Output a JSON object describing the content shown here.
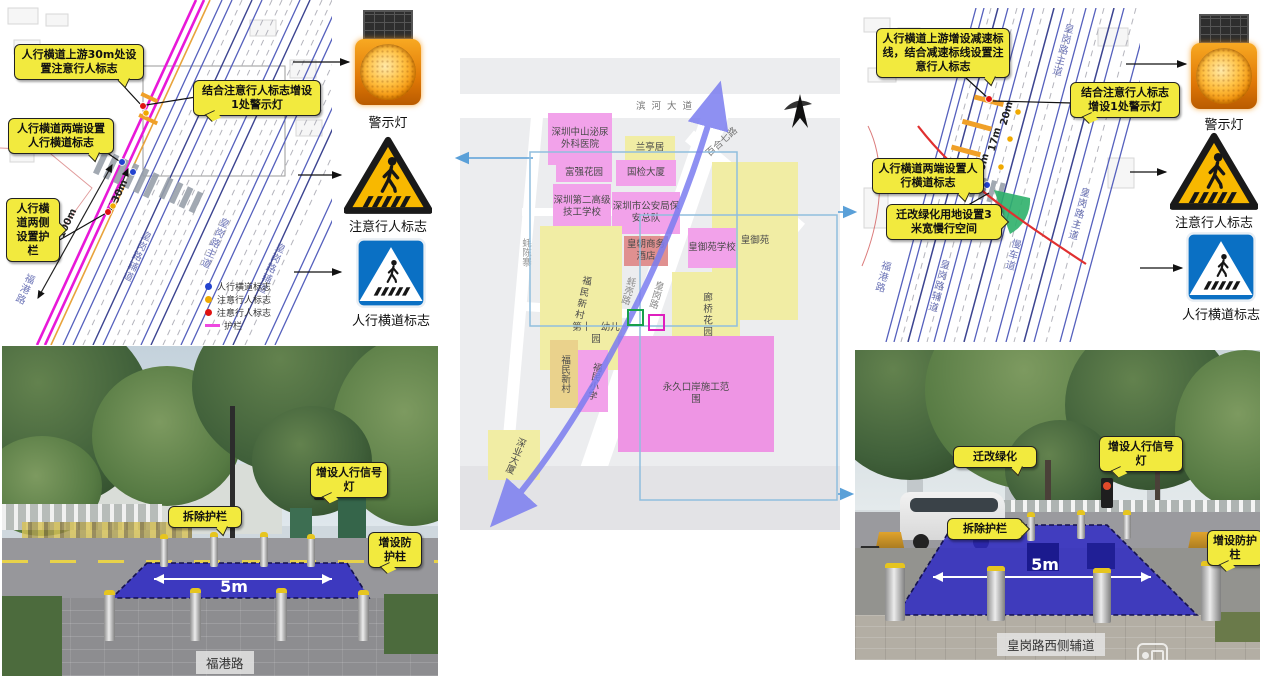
{
  "left_plan": {
    "callouts": [
      "人行横道上游30m处设置注意行人标志",
      "结合注意行人标志增设1处警示灯",
      "人行横道两端设置人行横道标志",
      "人行横道两侧设置护栏"
    ],
    "distances": [
      "100m",
      "30m"
    ],
    "roads": [
      "福港路",
      "皇岗路辅道",
      "皇岗路主道",
      "皇岗路辅道"
    ],
    "legend": [
      {
        "label": "人行横道标志",
        "color": "#2343cf"
      },
      {
        "label": "注意行人标志",
        "color": "#f0a900"
      },
      {
        "label": "注意行人标志",
        "color": "#e01212"
      },
      {
        "label": "护栏",
        "color": "#ee49e0"
      }
    ]
  },
  "signs": {
    "warning": "警示灯",
    "attention": "注意行人标志",
    "crosswalk": "人行横道标志"
  },
  "center_map": {
    "roads": {
      "binhe": "滨河大道",
      "baihe": "百合七路",
      "haochen": "蚝陈寨",
      "haoke": "蚝壳路",
      "huanggang": "皇岗路"
    },
    "blocks": [
      "深圳中山泌尿外科医院",
      "兰亭居",
      "富强花园",
      "国检大厦",
      "深圳第二高级技工学校",
      "深圳市公安局保安总队",
      "皇朝商务酒店",
      "福民新村",
      "皇御苑",
      "皇御苑学校",
      "廊桥花园",
      "第十一幼儿园",
      "福民新村",
      "福民小学",
      "永久口岸施工范围",
      "深业大厦"
    ]
  },
  "right_plan": {
    "callouts": [
      "人行横道上游增设减速标线，结合减速标线设置注意行人标志",
      "结合注意行人标志增设1处警示灯",
      "人行横道两端设置人行横道标志",
      "迁改绿化用地设置3米宽慢行空间"
    ],
    "distances": [
      "20m",
      "17m",
      "10m"
    ],
    "roads": [
      "福港路",
      "皇岗路辅道",
      "慢车道",
      "皇岗路主道",
      "皇岗路主道"
    ]
  },
  "photo_left": {
    "callouts": [
      "增设人行信号灯",
      "拆除护栏",
      "增设防护柱"
    ],
    "measurement": "5m",
    "caption": "福港路"
  },
  "photo_right": {
    "callouts": [
      "迁改绿化",
      "增设人行信号灯",
      "拆除护栏",
      "增设防护柱"
    ],
    "measurement": "5m",
    "caption": "皇岗路西侧辅道"
  },
  "colors": {
    "callout_bg": "#f2ea3e",
    "overlay_blue": "#2f2ac4",
    "plan_magenta": "#e818d8",
    "plan_blue": "#5560bd",
    "sign_yellow": "#f8b800",
    "sign_blue": "#0a70c4",
    "legend_rail": "#ee49e0",
    "green_space": "#2db06a"
  }
}
